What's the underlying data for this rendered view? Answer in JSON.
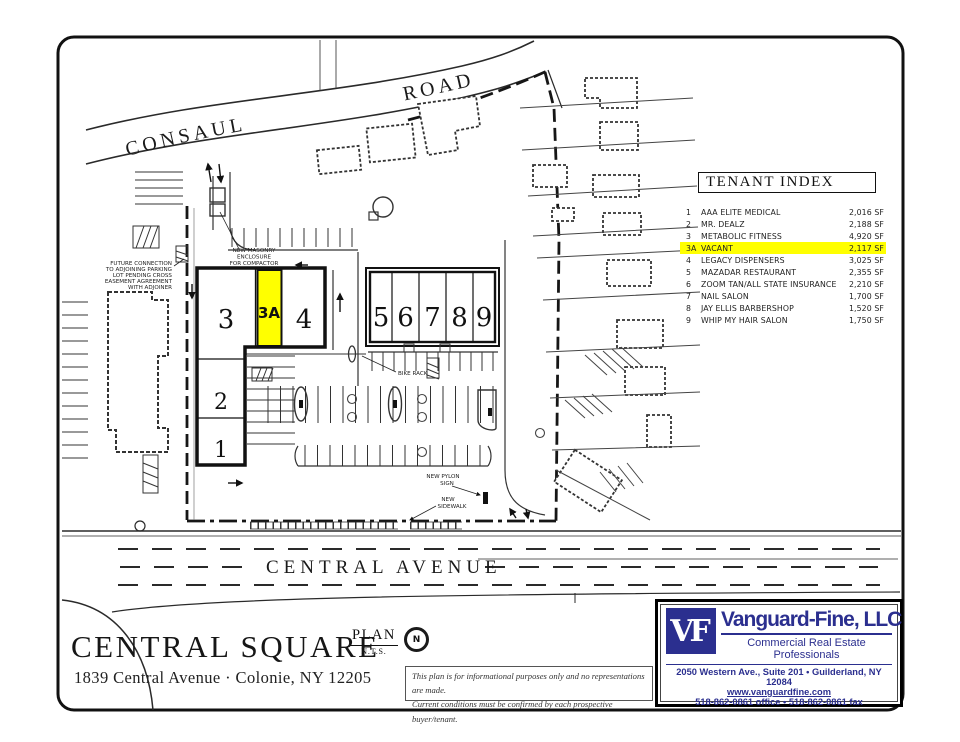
{
  "colors": {
    "highlight": "#ffff00",
    "brand_navy": "#2b2f8f"
  },
  "tenant_index": {
    "title": "TENANT INDEX",
    "rows": [
      {
        "unit": "1",
        "name": "AAA ELITE MEDICAL",
        "size": "2,016 SF",
        "highlight": false
      },
      {
        "unit": "2",
        "name": "MR. DEALZ",
        "size": "2,188 SF",
        "highlight": false
      },
      {
        "unit": "3",
        "name": "METABOLIC FITNESS",
        "size": "4,920 SF",
        "highlight": false
      },
      {
        "unit": "3A",
        "name": "VACANT",
        "size": "2,117 SF",
        "highlight": true
      },
      {
        "unit": "4",
        "name": "LEGACY DISPENSERS",
        "size": "3,025 SF",
        "highlight": false
      },
      {
        "unit": "5",
        "name": "MAZADAR RESTAURANT",
        "size": "2,355 SF",
        "highlight": false
      },
      {
        "unit": "6",
        "name": "ZOOM TAN/ALL STATE INSURANCE",
        "size": "2,210 SF",
        "highlight": false
      },
      {
        "unit": "7",
        "name": "NAIL SALON",
        "size": "1,700 SF",
        "highlight": false
      },
      {
        "unit": "8",
        "name": "JAY ELLIS BARBERSHOP",
        "size": "1,520 SF",
        "highlight": false
      },
      {
        "unit": "9",
        "name": "WHIP MY HAIR SALON",
        "size": "1,750 SF",
        "highlight": false
      }
    ]
  },
  "plan": {
    "roads": {
      "consaul_1": "CONSAUL",
      "consaul_2": "ROAD",
      "central_1": "CENTRAL",
      "central_2": "AVENUE"
    },
    "unit_labels": {
      "u1": "1",
      "u2": "2",
      "u3": "3",
      "u3a": "3A",
      "u4": "4",
      "u5": "5",
      "u6": "6",
      "u7": "7",
      "u8": "8",
      "u9": "9"
    },
    "annotations": {
      "compactor": [
        "NEW MASONRY",
        "ENCLOSURE",
        "FOR COMPACTOR"
      ],
      "future_connection": [
        "FUTURE CONNECTION",
        "TO ADJOINING PARKING",
        "LOT PENDING CROSS",
        "EASEMENT AGREEMENT",
        "WITH ADJOINER"
      ],
      "bike_rack": "BIKE RACK",
      "pylon_sign": [
        "NEW PYLON",
        "SIGN"
      ],
      "sidewalk": [
        "NEW",
        "SIDEWALK"
      ]
    },
    "plan_label": "PLAN",
    "plan_scale": "N.T.S.",
    "north": "N"
  },
  "footer": {
    "title": "CENTRAL SQUARE",
    "address": "1839 Central Avenue · Colonie, NY 12205"
  },
  "disclaimer": {
    "line1": "This plan is for informational purposes only and no representations are made.",
    "line2": "Current conditions must be confirmed by each prospective buyer/tenant."
  },
  "broker": {
    "initials": "VF",
    "name": "Vanguard-Fine, LLC",
    "tagline": "Commercial Real Estate Professionals",
    "address_line": "2050 Western Ave., Suite 201 • Guilderland, NY 12084",
    "website": "www.vanguardfine.com",
    "phone_line": "518-862-0861 office • 518-862-0861 fax"
  }
}
